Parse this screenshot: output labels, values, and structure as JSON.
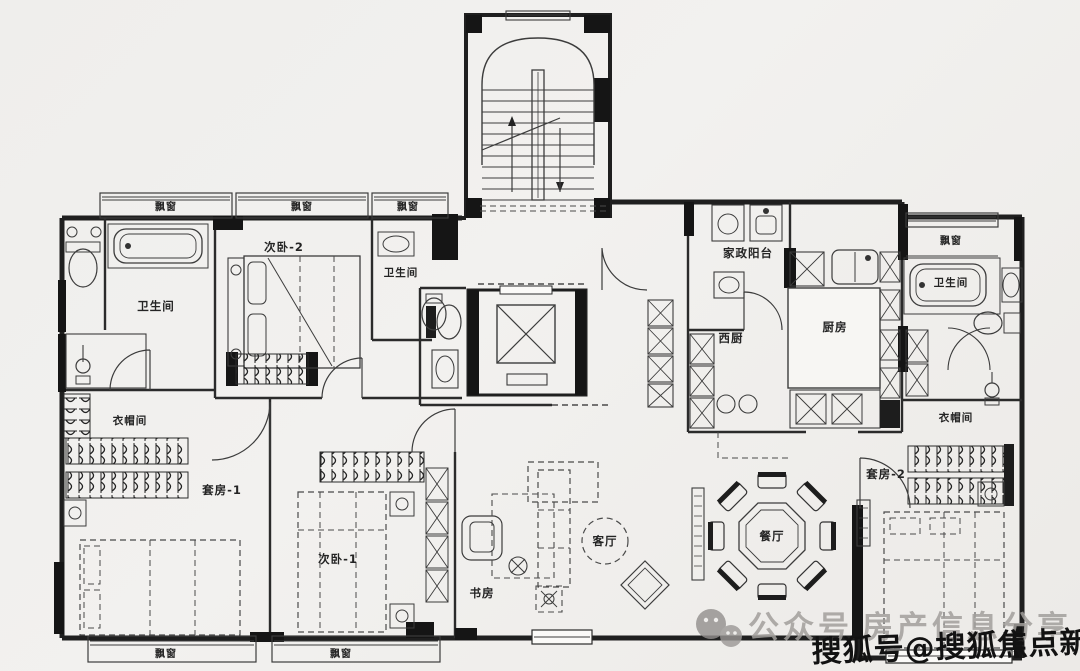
{
  "plan": {
    "background": "#efeeec",
    "wall_color": "#1f1f1f",
    "furniture_color": "#3c3c3c",
    "labels": [
      {
        "name": "bay-window-top-1",
        "text": "飘窗",
        "x": 166,
        "y": 210,
        "size": 10
      },
      {
        "name": "bay-window-top-2",
        "text": "飘窗",
        "x": 302,
        "y": 210,
        "size": 10
      },
      {
        "name": "bay-window-top-3",
        "text": "飘窗",
        "x": 408,
        "y": 210,
        "size": 10
      },
      {
        "name": "bathroom-left",
        "text": "卫生间",
        "x": 156,
        "y": 310,
        "size": 11.5
      },
      {
        "name": "bedroom-2",
        "text": "次卧-2",
        "x": 284,
        "y": 251,
        "size": 11.5
      },
      {
        "name": "bathroom-2",
        "text": "卫生间",
        "x": 401,
        "y": 276,
        "size": 10.5
      },
      {
        "name": "laundry-balcony",
        "text": "家政阳台",
        "x": 748,
        "y": 257,
        "size": 11.5
      },
      {
        "name": "west-kitchen",
        "text": "西厨",
        "x": 731,
        "y": 342,
        "size": 11.5
      },
      {
        "name": "kitchen",
        "text": "厨房",
        "x": 835,
        "y": 331,
        "size": 11.5
      },
      {
        "name": "bay-window-right",
        "text": "飘窗",
        "x": 951,
        "y": 244,
        "size": 10
      },
      {
        "name": "bathroom-right",
        "text": "卫生间",
        "x": 951,
        "y": 286,
        "size": 10.5
      },
      {
        "name": "closet-right",
        "text": "衣帽间",
        "x": 956,
        "y": 421,
        "size": 10.5
      },
      {
        "name": "closet-left",
        "text": "衣帽间",
        "x": 130,
        "y": 424,
        "size": 10.5
      },
      {
        "name": "suite-1",
        "text": "套房-1",
        "x": 222,
        "y": 494,
        "size": 11.5
      },
      {
        "name": "suite-2",
        "text": "套房-2",
        "x": 886,
        "y": 478,
        "size": 11.5
      },
      {
        "name": "bedroom-1",
        "text": "次卧-1",
        "x": 338,
        "y": 563,
        "size": 11.5
      },
      {
        "name": "living-room",
        "text": "客厅",
        "x": 605,
        "y": 545,
        "size": 11.5
      },
      {
        "name": "study",
        "text": "书房",
        "x": 482,
        "y": 597,
        "size": 11.5
      },
      {
        "name": "dining-room",
        "text": "餐厅",
        "x": 772,
        "y": 540,
        "size": 11.5
      },
      {
        "name": "bay-window-bottom-1",
        "text": "飘窗",
        "x": 166,
        "y": 657,
        "size": 10
      },
      {
        "name": "bay-window-bottom-2",
        "text": "飘窗",
        "x": 341,
        "y": 657,
        "size": 10
      }
    ]
  },
  "watermark": {
    "wechat_label": "公众号",
    "gray_text": "房产信息分享",
    "sohu_text": "搜狐号@搜狐焦点新余站",
    "gray_color": "#a29f9c",
    "sohu_color": "#121212"
  }
}
